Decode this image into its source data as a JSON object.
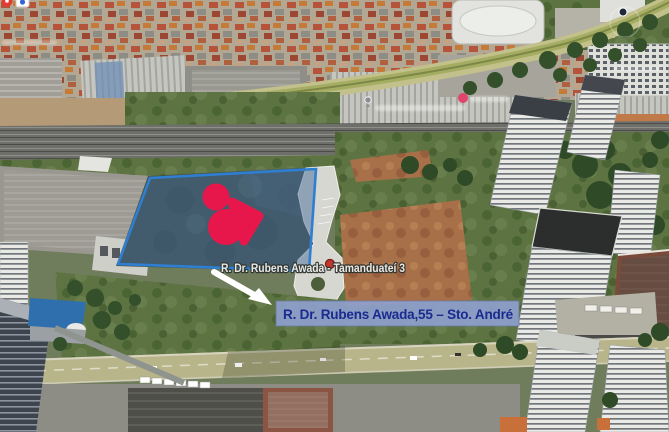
{
  "map": {
    "view_type": "3d aerial satellite view",
    "annotations": {
      "street_pin_label": "R. Dr. Rubens Awada - Tamanduateí 3",
      "address_banner": "R. Dr. Rubens Awada,55 – Sto. André"
    },
    "colors": {
      "highlight_fill": "#3c6796",
      "highlight_stroke": "#2e7fd2",
      "heart_marker": "#e8174b",
      "street_pin": "#c4372e",
      "address_text": "#1a2a8f",
      "address_bg": "#8fa0cc",
      "arrow": "#ffffff",
      "street_label_text": "#f0efec"
    },
    "icons": [
      {
        "name": "red-map-pin-icon"
      },
      {
        "name": "info-tile-icon"
      },
      {
        "name": "gray-place-pin-icon"
      },
      {
        "name": "pink-place-dot-icon"
      },
      {
        "name": "poi-dot-icon"
      },
      {
        "name": "street-pin-dot"
      },
      {
        "name": "heart-marker"
      },
      {
        "name": "annotation-arrow"
      }
    ],
    "illegible_small_map_labels": 4
  }
}
